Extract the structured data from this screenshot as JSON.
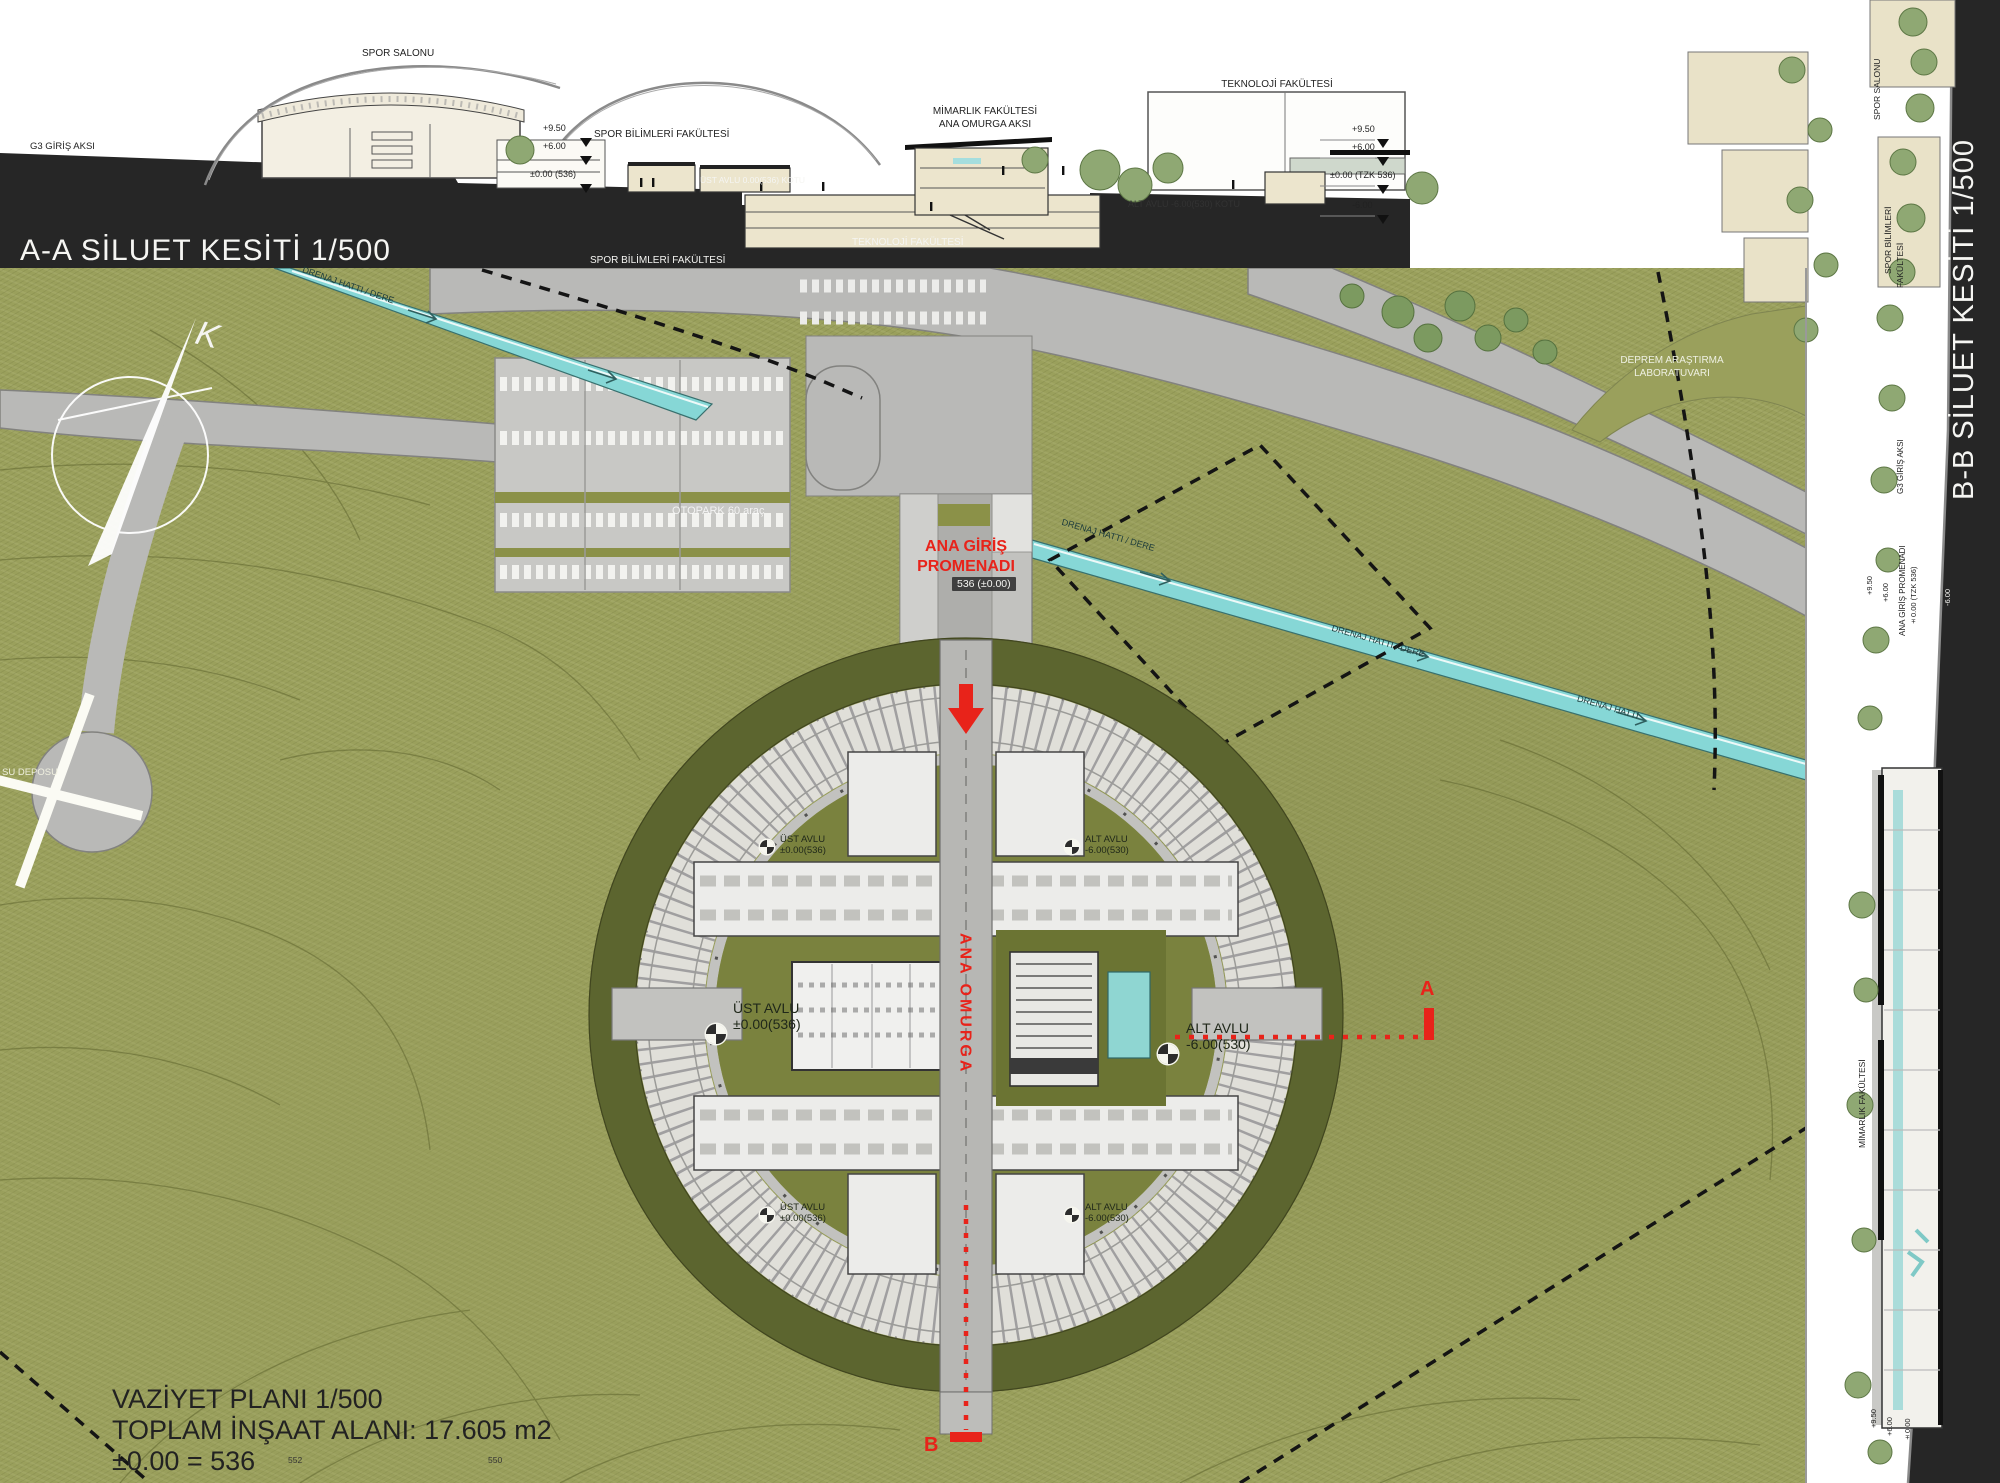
{
  "colors": {
    "band": "#262626",
    "terrain": "#9aa05c",
    "road": "#b9b9b7",
    "stream": "#86d7d6",
    "red": "#e8231a",
    "cream": "#ece5cd",
    "courtyard": "#7a823e",
    "berm": "#5c652f",
    "pool": "#8fd6d2"
  },
  "section_a": {
    "title": "A-A SİLUET KESİTİ 1/500",
    "labels": {
      "g3_axis": "G3 GİRİŞ AKSI",
      "spor_salonu": "SPOR SALONU",
      "spor_bilimleri": "SPOR BİLİMLERİ FAKÜLTESİ",
      "mimarlik_1": "MİMARLIK FAKÜLTESİ",
      "mimarlik_2": "ANA OMURGA AKSI",
      "teknoloji": "TEKNOLOJİ FAKÜLTESİ",
      "ust_avlu_kotu": "ÜST AVLU 0.00(536) KOTU",
      "alt_avlu_kotu": "ALT AVLU -6.00(530) KOTU"
    },
    "levels_left": [
      "+9.50",
      "+6.00",
      "±0.00 (536)"
    ],
    "levels_right": [
      "+9.50",
      "+6.00",
      "±0.00 (TZK 536)",
      "-6.00"
    ]
  },
  "section_b": {
    "title": "B-B SİLUET KESİTİ 1/500",
    "labels": {
      "spor_salonu": "SPOR SALONU",
      "spor_bilimleri_1": "SPOR BİLİMLERİ",
      "spor_bilimleri_2": "FAKÜLTESİ",
      "g3_axis": "G3 GİRİŞ AKSI",
      "ana_giris": "ANA GİRİŞ PROMENADI",
      "tzk": "±0.00 (TZK 536)",
      "mimarlik": "MİMARLIK FAKÜLTESİ"
    },
    "levels_top": [
      "+9.50",
      "+6.00",
      "-6.00"
    ],
    "levels_bottom": [
      "+9.50",
      "+6.00",
      "±0.00"
    ]
  },
  "plan": {
    "title_1": "VAZİYET PLANI 1/500",
    "title_2": "TOPLAM İNŞAAT ALANI: 17.605 m2",
    "title_3": "±0.00 = 536",
    "compass_letter": "K",
    "labels": {
      "otopark": "OTOPARK 60 araç",
      "ana_giris_1": "ANA GİRİŞ",
      "ana_giris_2": "PROMENADI",
      "ana_giris_level": "536 (±0.00)",
      "ana_omurga": "ANA OMURGA",
      "su_deposu": "SU DEPOSU",
      "spor_bilimleri": "SPOR BİLİMLERİ FAKÜLTESİ",
      "teknoloji": "TEKNOLOJİ FAKÜLTESİ",
      "deprem_1": "DEPREM ARAŞTIRMA",
      "deprem_2": "LABORATUVARI"
    },
    "drainage_labels": [
      {
        "text": "DRENAJ HATTI / DERE"
      },
      {
        "text": "DRENAJ HATTI / DERE"
      },
      {
        "text": "DRENAJ HATTI / DERE"
      },
      {
        "text": "DRENAJ HATTI"
      }
    ],
    "courtyards": [
      {
        "name": "ÜST AVLU",
        "level": "±0.00(536)"
      },
      {
        "name": "ALT AVLU",
        "level": "-6.00(530)"
      },
      {
        "name": "ÜST AVLU",
        "level": "±0.00(536)"
      },
      {
        "name": "ALT AVLU",
        "level": "-6.00(530)"
      },
      {
        "name": "ÜST AVLU",
        "level": "±0.00(536)"
      },
      {
        "name": "ALT AVLU",
        "level": "-6.00(530)"
      }
    ],
    "section_markers": {
      "a": "A",
      "b": "B"
    },
    "contour_labels": [
      "552",
      "550"
    ]
  }
}
